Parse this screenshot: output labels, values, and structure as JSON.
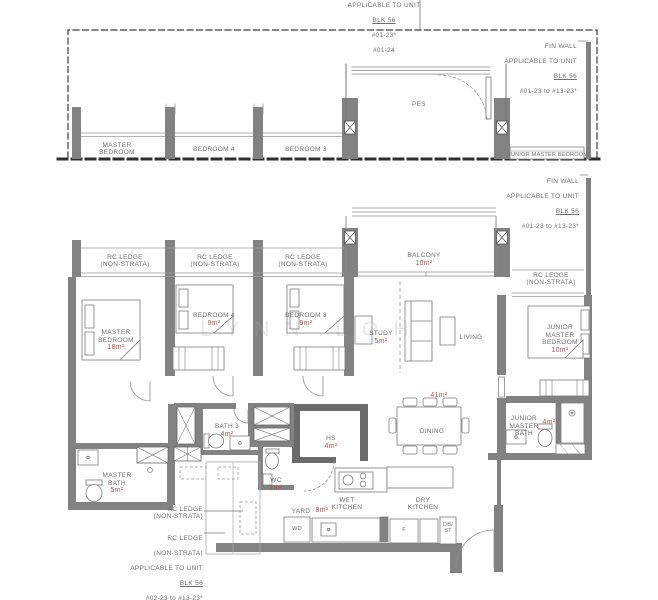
{
  "colors": {
    "wall": "#828282",
    "area_text": "#bb4f4c",
    "label_text": "#6e6e6e"
  },
  "watermark": "LYNN LOH",
  "upper_plan": {
    "note_top": {
      "l1": "APPLICABLE TO UNIT",
      "blk": "BLK 56",
      "l3": "#01-23*",
      "l4": "#01-24"
    },
    "fin_wall_note": {
      "l1": "FIN WALL",
      "l2": "APPLICABLE TO UNIT",
      "blk": "BLK 56",
      "range": "#01-23 to #13-23*"
    },
    "rooms": {
      "master_bedroom": "MASTER\nBEDROOM",
      "bedroom4": "BEDROOM 4",
      "bedroom3": "BEDROOM 3",
      "pes": "PES",
      "junior_master_bedroom": "JUNIOR MASTER BEDROOM"
    }
  },
  "main_plan": {
    "fin_wall_note": {
      "l1": "FIN WALL",
      "l2": "APPLICABLE TO UNIT",
      "blk": "BLK 56",
      "range": "#01-23 to #13-23*"
    },
    "rc_ledge": "RC LEDGE\n(NON-STRATA)",
    "rooms": {
      "balcony": {
        "name": "BALCONY",
        "area": "10m²"
      },
      "master_bedroom": {
        "name": "MASTER\nBEDROOM",
        "area": "18m²"
      },
      "bedroom4": {
        "name": "BEDROOM 4",
        "area": "9m²"
      },
      "bedroom3": {
        "name": "BEDROOM 3",
        "area": "9m²"
      },
      "study": {
        "name": "STUDY",
        "area": "5m²"
      },
      "living": {
        "name": "LIVING"
      },
      "junior_master_bedroom": {
        "name": "JUNIOR\nMASTER\nBEDROOM",
        "area": "10m²"
      },
      "living_dining_area": "41m²",
      "dining": {
        "name": "DINING"
      },
      "hs": {
        "name": "HS",
        "area": "4m²"
      },
      "bath3": {
        "name": "BATH 3",
        "area": "4m²"
      },
      "master_bath": {
        "name": "MASTER\nBATH",
        "area": "5m²"
      },
      "wc": {
        "name": "WC",
        "area": "1m²"
      },
      "yard": {
        "name": "YARD",
        "area": "8m²"
      },
      "wet_kitchen": "WET\nKITCHEN",
      "dry_kitchen": "DRY\nKITCHEN",
      "junior_master_bath": {
        "name": "JUNIOR\nMASTER\nBATH",
        "area": "4m²"
      },
      "wd": "WD",
      "fridge": "F",
      "db_st": "DB/\nST"
    },
    "ac_ledge_note": "AC LEDGE\n(NON-STRATA)",
    "rc_ledge_note": {
      "l1": "RC LEDGE",
      "l2": "(NON-STRATA)",
      "l3": "APPLICABLE TO UNIT",
      "blk": "BLK 56",
      "r1": "#02-23 to #13-23*",
      "r2": "#02-24 to #13-24"
    }
  }
}
